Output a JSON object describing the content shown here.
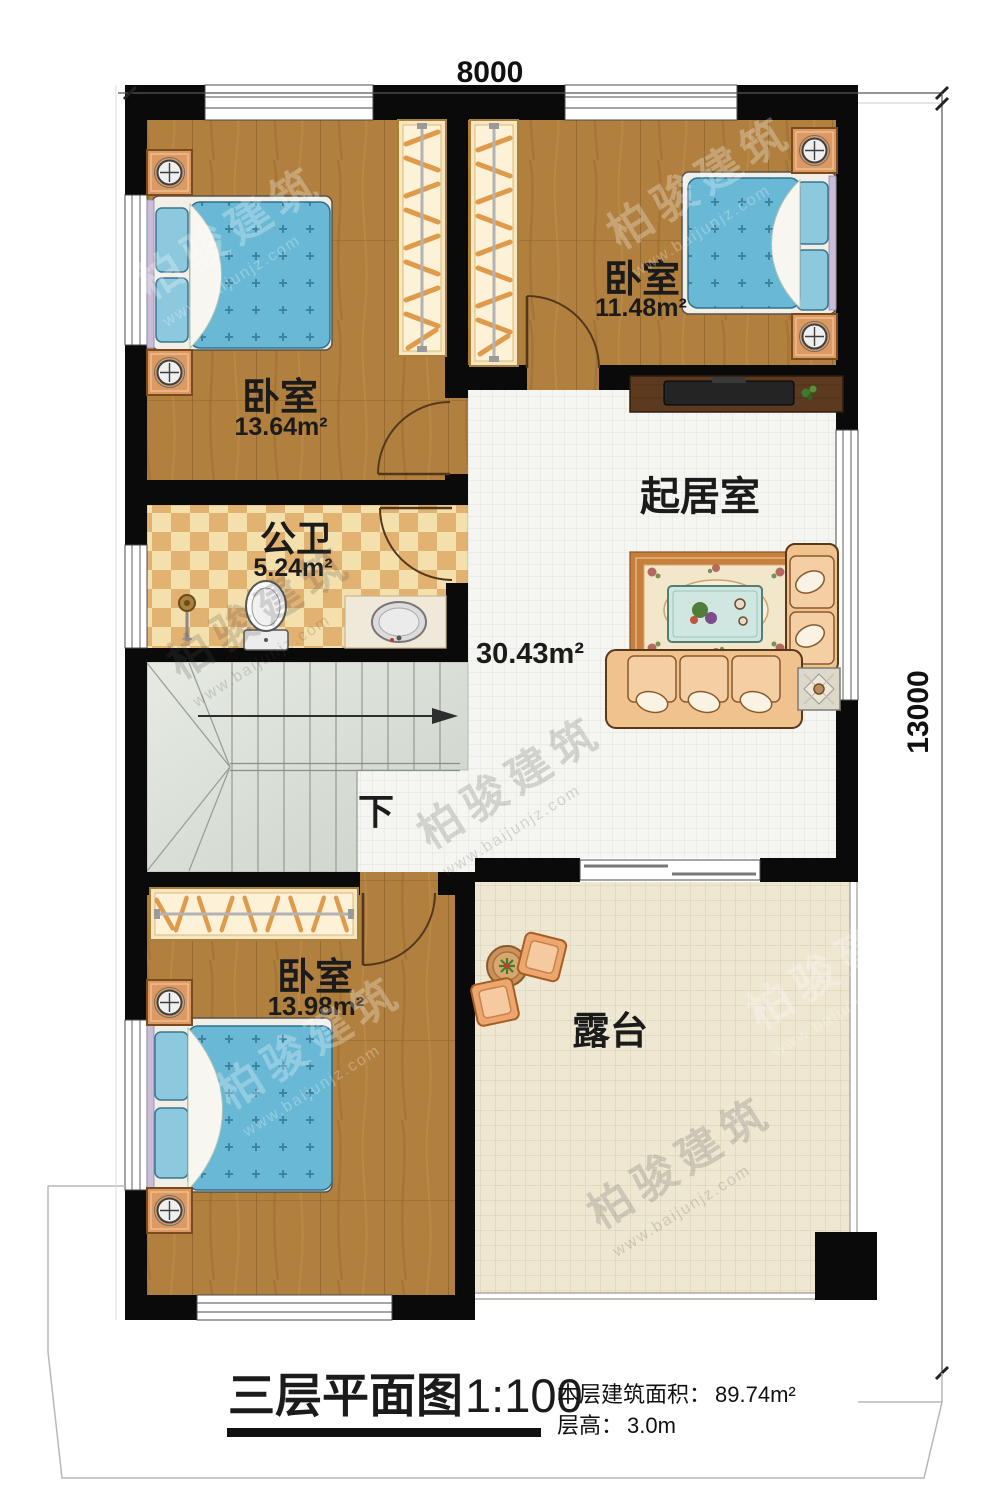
{
  "plan": {
    "dimensions": {
      "width_label": "8000",
      "height_label": "13000"
    },
    "rooms": {
      "bedroom_top_left": {
        "name": "卧室",
        "area": "13.64m²"
      },
      "bedroom_top_right": {
        "name": "卧室",
        "area": "11.48m²"
      },
      "bathroom": {
        "name": "公卫",
        "area": "5.24m²"
      },
      "living_room": {
        "name": "起居室",
        "area": "30.43m²"
      },
      "bedroom_bottom": {
        "name": "卧室",
        "area": "13.98m²"
      },
      "terrace": {
        "name": "露台"
      }
    },
    "stairs": {
      "direction_label": "下"
    }
  },
  "title_block": {
    "title": "三层平面图",
    "scale": "1:100",
    "area_label": "本层建筑面积：",
    "area_value": "89.74m²",
    "height_label": "层高：",
    "height_value": "3.0m"
  },
  "watermark": {
    "brand": "柏骏建筑",
    "website": "www.baijunjz.com"
  },
  "colors": {
    "wall": "#0a0a0a",
    "wood_floor": "#b1803f",
    "living_tile": "#f5f5f2",
    "terrace_tile": "#eee7d2",
    "bath_tile_dark": "#e2b271",
    "bath_tile_light": "#f4e0ac",
    "stair_floor": "#dce1d8",
    "bed_blue": "#69b8d5",
    "furniture_tan": "#f0c28e"
  }
}
